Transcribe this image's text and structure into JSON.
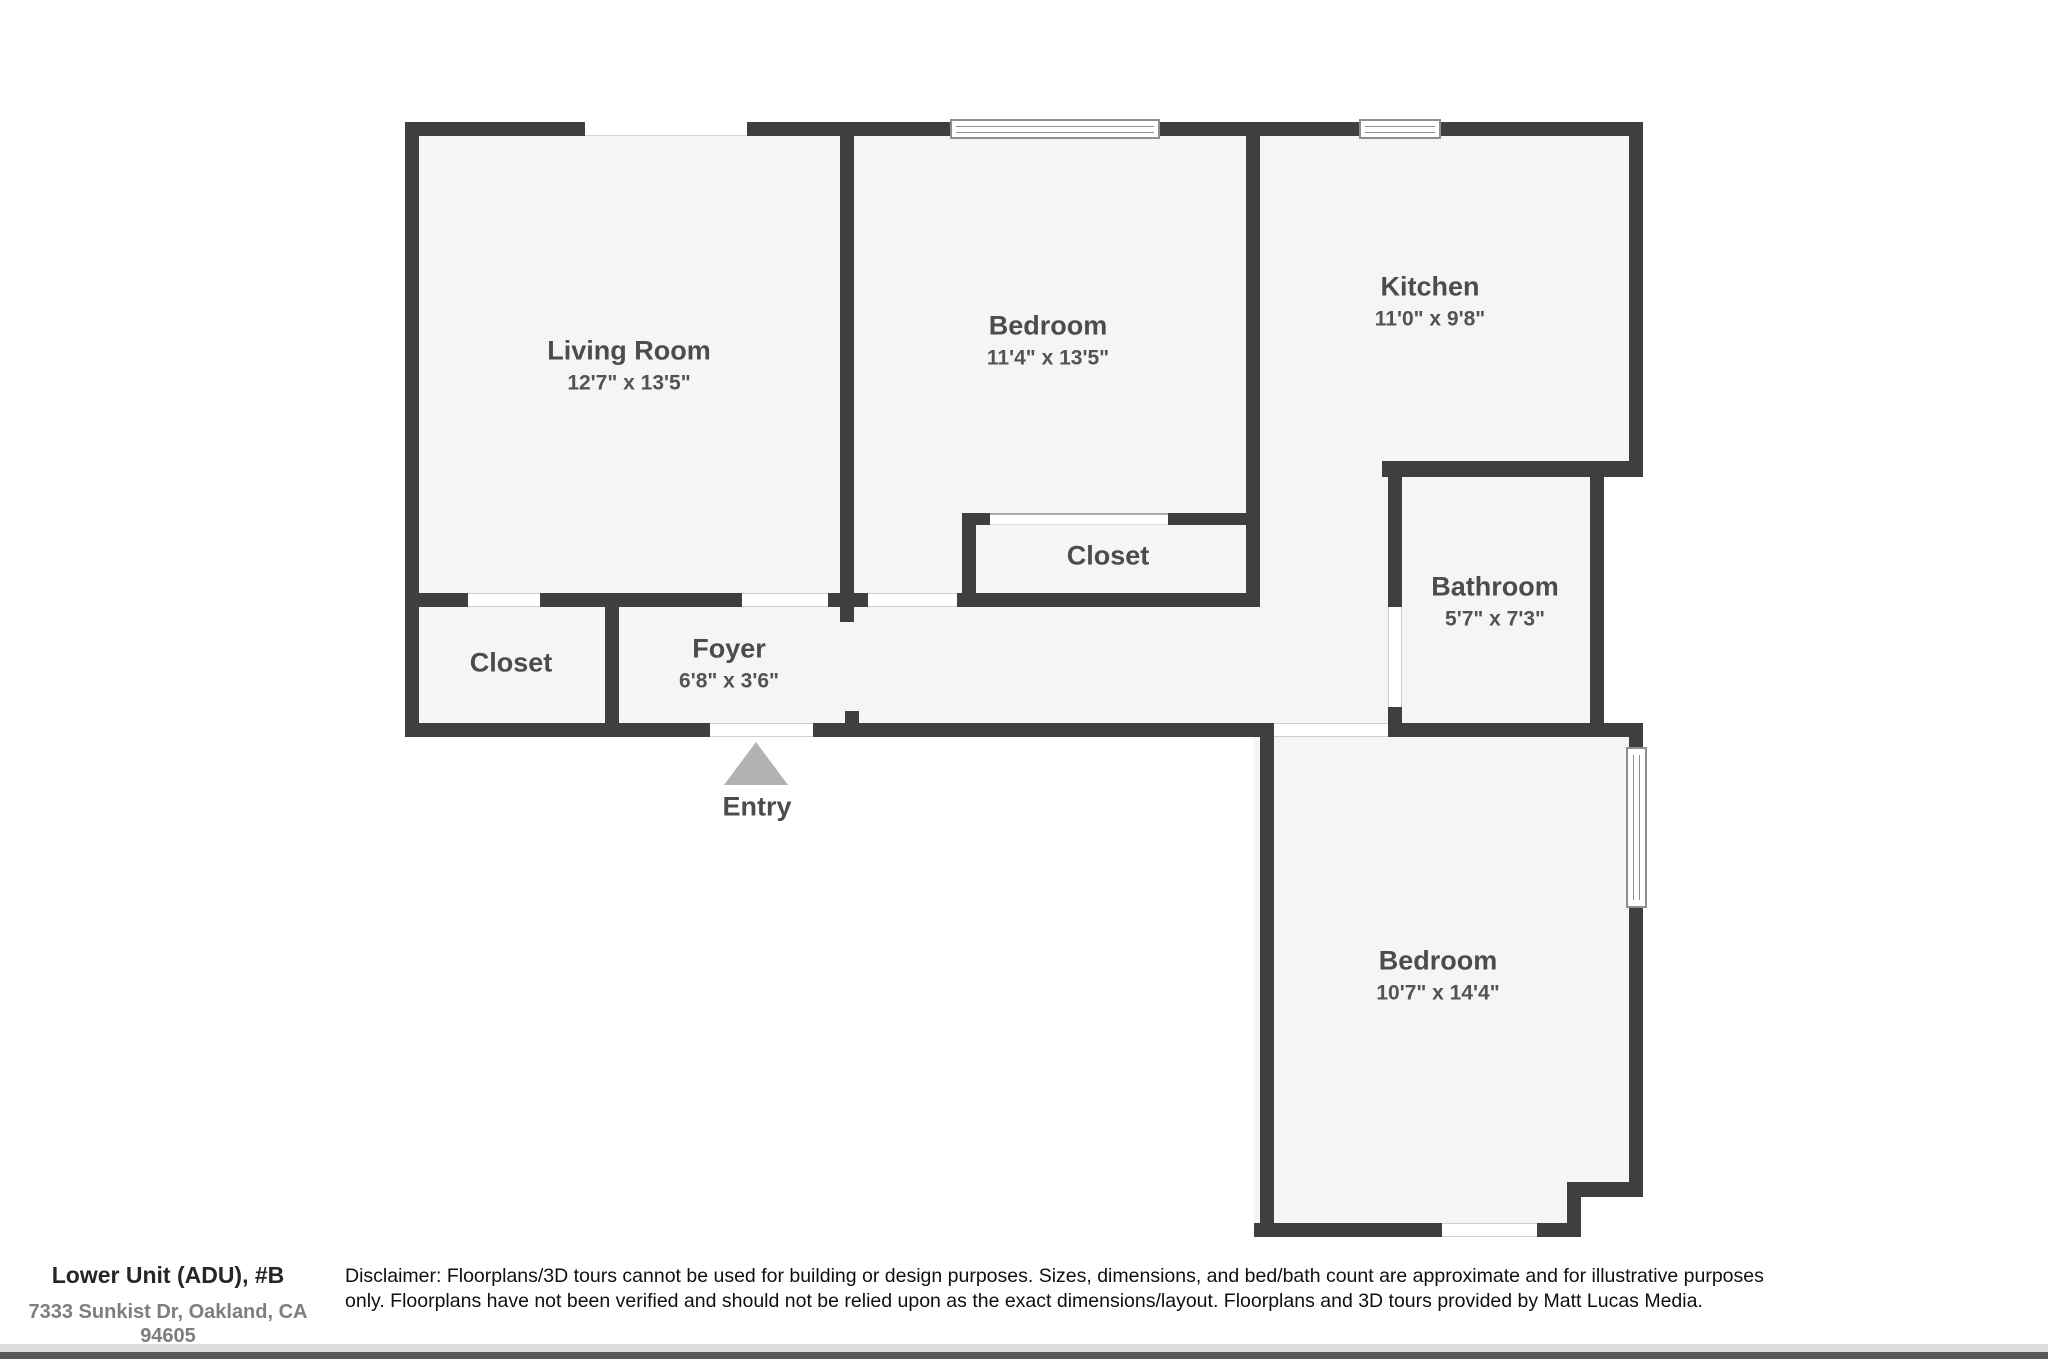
{
  "plan": {
    "rooms": {
      "living_room": {
        "name": "Living Room",
        "dims": "12'7\" x 13'5\""
      },
      "bedroom_top": {
        "name": "Bedroom",
        "dims": "11'4\" x 13'5\""
      },
      "kitchen": {
        "name": "Kitchen",
        "dims": "11'0\" x 9'8\""
      },
      "closet_bedroom": {
        "name": "Closet"
      },
      "bathroom": {
        "name": "Bathroom",
        "dims": "5'7\" x 7'3\""
      },
      "closet_entry": {
        "name": "Closet"
      },
      "foyer": {
        "name": "Foyer",
        "dims": "6'8\" x 3'6\""
      },
      "bedroom_bottom": {
        "name": "Bedroom",
        "dims": "10'7\" x 14'4\""
      },
      "entry": {
        "label": "Entry"
      }
    },
    "colors": {
      "wall": "#3f3f3f",
      "floor": "#f5f5f6",
      "entry_arrow": "#b2b2b2"
    }
  },
  "footer": {
    "unit_title": "Lower Unit (ADU), #B",
    "address": "7333 Sunkist Dr, Oakland, CA 94605",
    "disclaimer": "Disclaimer: Floorplans/3D tours cannot be used for building or design purposes. Sizes, dimensions, and bed/bath count are approximate and for illustrative purposes only. Floorplans have not been verified and should not be relied upon as the exact dimensions/layout. Floorplans and 3D tours provided by Matt Lucas Media."
  }
}
